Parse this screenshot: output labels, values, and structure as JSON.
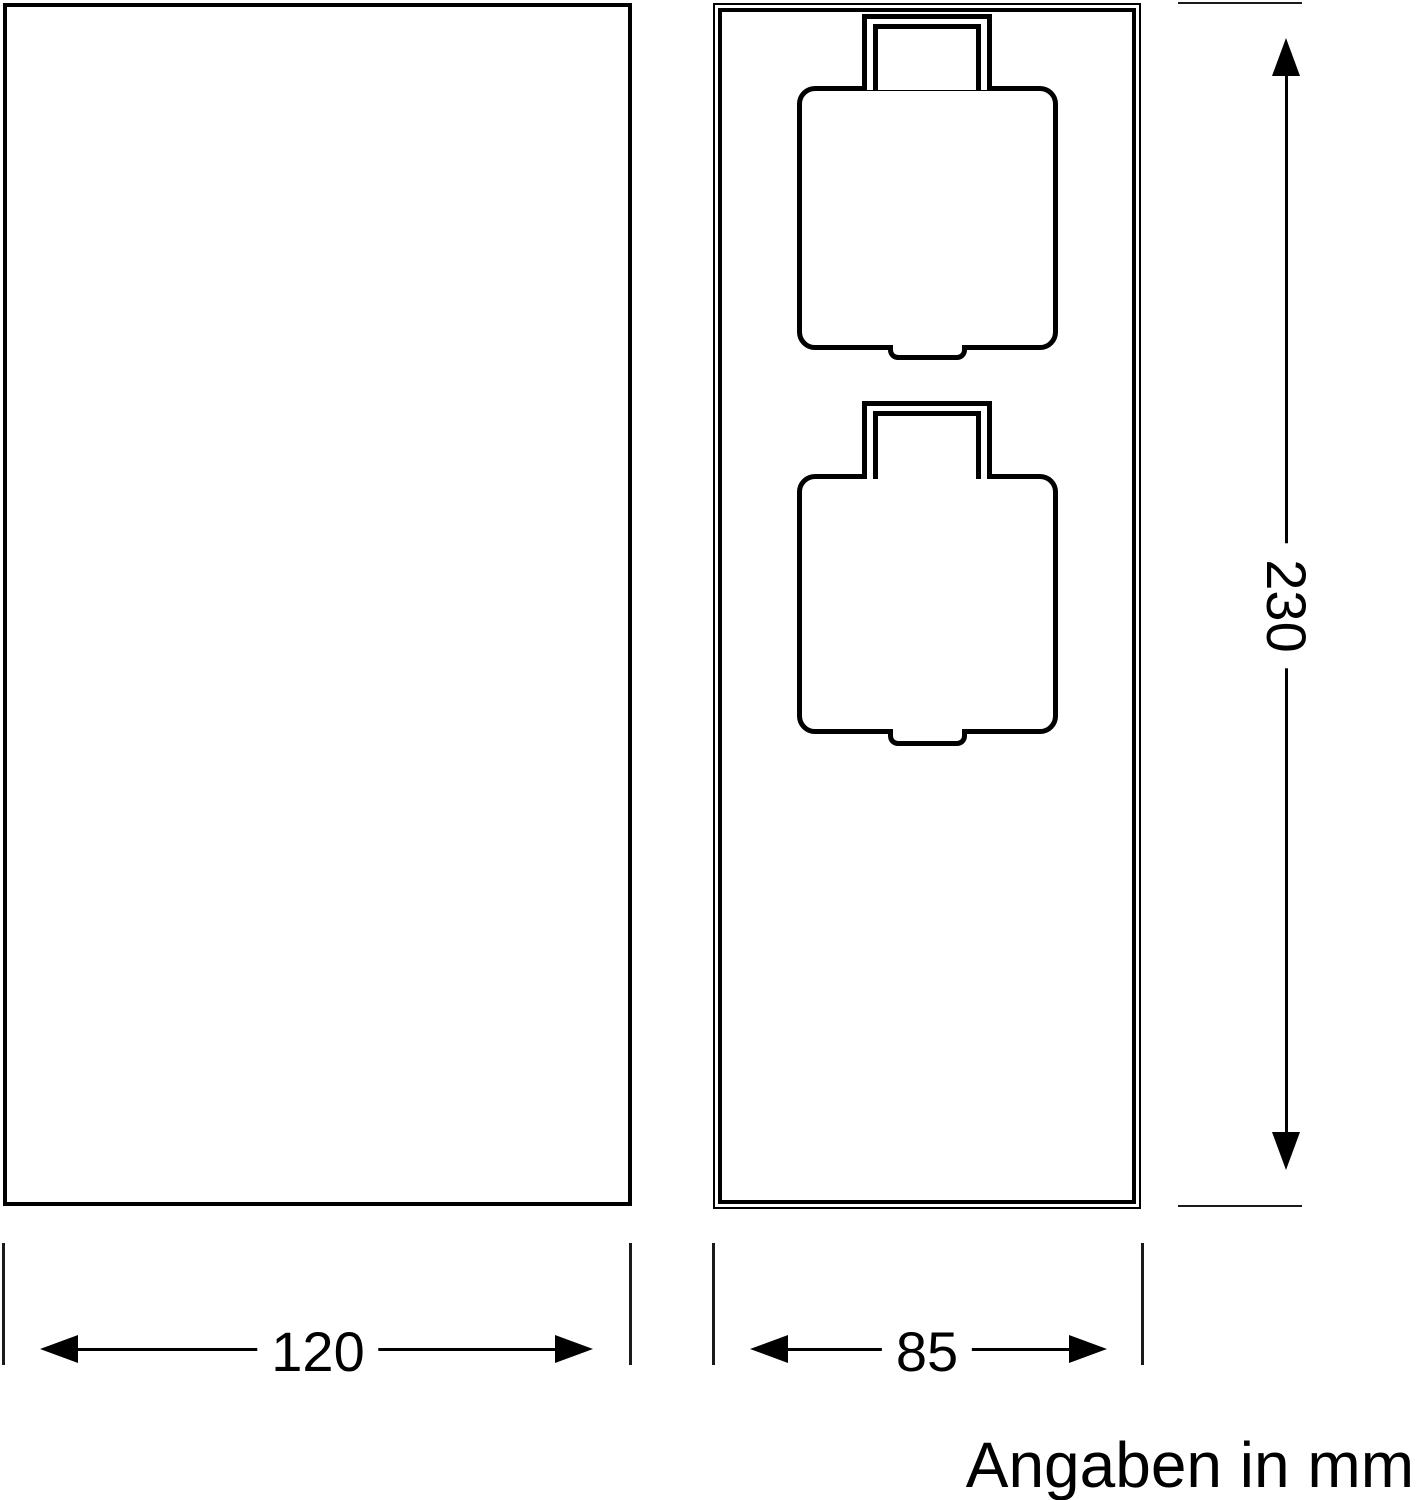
{
  "drawing": {
    "type": "technical-dimension-drawing",
    "views": {
      "front": {
        "name": "front-view"
      },
      "side": {
        "name": "side-view-with-two-socket-covers"
      }
    },
    "dimensions": {
      "front_width": "120",
      "side_width": "85",
      "height": "230"
    },
    "caption": "Angaben in mm",
    "colors": {
      "line": "#000000",
      "background": "#ffffff"
    }
  }
}
